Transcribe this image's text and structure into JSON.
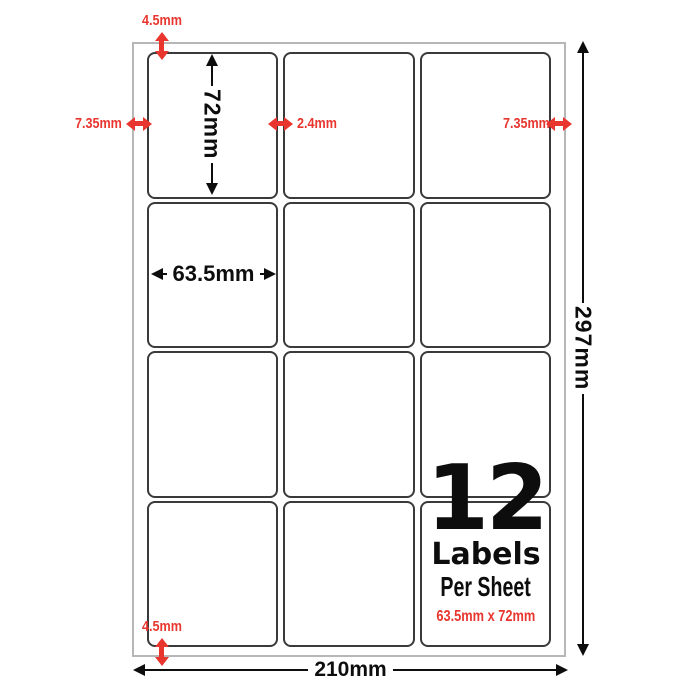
{
  "sheet": {
    "rows": 4,
    "columns": 3,
    "label_count": 12
  },
  "dims_black": {
    "label_height": "72mm",
    "label_width": "63.5mm",
    "page_height": "297mm",
    "page_width": "210mm"
  },
  "dims_red": {
    "top_margin": "4.5mm",
    "bottom_margin": "4.5mm",
    "left_margin": "7.35mm",
    "right_margin": "7.35mm",
    "column_gap": "2.4mm"
  },
  "badge": {
    "count": "12",
    "word": "Labels",
    "per_sheet": "Per Sheet",
    "label_size": "63.5mm x 72mm"
  },
  "colors": {
    "accent_red": "#e8362f",
    "ink": "#0d0d0d",
    "label_border": "#3a3a3a",
    "sheet_border": "#b7b7b7"
  }
}
